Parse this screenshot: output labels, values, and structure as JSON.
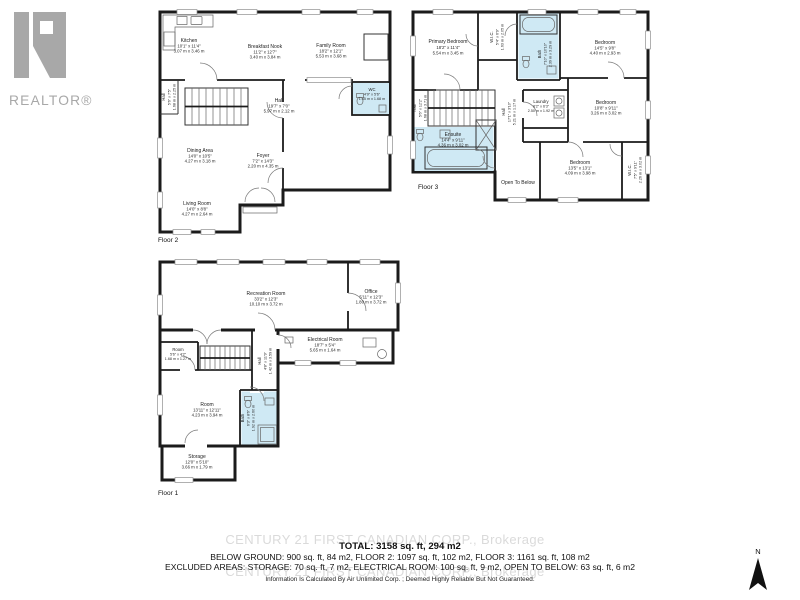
{
  "colors": {
    "wall": "#1b1b1b",
    "bath_fill": "#cfe9f4",
    "watermark": "#c5c5c5",
    "logo_gray": "#a8a8a8",
    "text": "#1c1c1c"
  },
  "logo": {
    "brand": "REALTOR®"
  },
  "compass": {
    "label": "N"
  },
  "watermark": {
    "text": "CENTURY 21 FIRST CANADIAN CORP., Brokerage"
  },
  "summary": {
    "total": "TOTAL: 3158 sq. ft, 294 m2",
    "line2": "BELOW GROUND: 900 sq. ft, 84 m2, FLOOR 2: 1097 sq. ft, 102 m2, FLOOR 3: 1161 sq. ft, 108 m2",
    "line3": "EXCLUDED AREAS: STORAGE: 70 sq. ft, 7 m2, ELECTRICAL ROOM: 100 sq. ft, 9 m2, OPEN TO BELOW: 63 sq. ft, 6 m2",
    "disclaimer": "Information Is Calculated By Air Unlimited Corp. ; Deemed Highly Reliable But Not Guaranteed."
  },
  "floor2": {
    "label": "Floor 2",
    "rooms": {
      "kitchen": {
        "name": "Kitchen",
        "imperial": "10'1\" x 11'4\"",
        "metric": "3.07 m x 3.46 m"
      },
      "breakfast_nook": {
        "name": "Breakfast Nook",
        "imperial": "11'2\" x 12'7\"",
        "metric": "3.40 m x 3.84 m"
      },
      "family_room": {
        "name": "Family Room",
        "imperial": "18'2\" x 12'1\"",
        "metric": "5.53 m x 3.68 m"
      },
      "hall_side": {
        "name": "Hall",
        "imperial": "5'6\" x 7'5\"",
        "metric": "1.68 m x 2.25 m"
      },
      "hall": {
        "name": "Hall",
        "imperial": "19'7\" x 7'0\"",
        "metric": "5.97 m x 2.12 m"
      },
      "wc": {
        "name": "WC",
        "imperial": "4'9\" x 5'6\"",
        "metric": "1.45 m x 1.68 m"
      },
      "dining_area": {
        "name": "Dining Area",
        "imperial": "14'0\" x 10'5\"",
        "metric": "4.27 m x 3.18 m"
      },
      "foyer": {
        "name": "Foyer",
        "imperial": "7'2\" x 14'3\"",
        "metric": "2.20 m x 4.35 m"
      },
      "living_room": {
        "name": "Living Room",
        "imperial": "14'0\" x 8'8\"",
        "metric": "4.27 m x 2.64 m"
      }
    }
  },
  "floor3": {
    "label": "Floor 3",
    "rooms": {
      "primary_bedroom": {
        "name": "Primary Bedroom",
        "imperial": "18'2\" x 11'4\"",
        "metric": "5.54 m x 3.45 m"
      },
      "wic_top": {
        "name": "W.I.C.",
        "imperial": "5'4\" x 6'9\"",
        "metric": "1.63 m x 2.05 m"
      },
      "bath": {
        "name": "Bath",
        "imperial": "7'10\" x 10'10\"",
        "metric": "2.39 m x 3.29 m"
      },
      "bedroom_ne": {
        "name": "Bedroom",
        "imperial": "14'5\" x 9'8\"",
        "metric": "4.40 m x 2.93 m"
      },
      "hall_stairs": {
        "name": "Hall",
        "imperial": "5'6\" x 12'2\"",
        "metric": "1.68 m x 3.71 m"
      },
      "hall_center": {
        "name": "Hall",
        "imperial": "17'1\" x 3'10\"",
        "metric": "5.21 m x 1.17 m"
      },
      "laundry": {
        "name": "Laundry",
        "imperial": "8'2\" x 6'3\"",
        "metric": "2.50 m x 1.92 m"
      },
      "bedroom_e": {
        "name": "Bedroom",
        "imperial": "10'8\" x 9'11\"",
        "metric": "3.26 m x 3.02 m"
      },
      "ensuite": {
        "name": "Ensuite",
        "imperial": "14'4\" x 9'11\"",
        "metric": "4.36 m x 3.02 m"
      },
      "open_to_below": {
        "name": "Open To Below"
      },
      "bedroom_s": {
        "name": "Bedroom",
        "imperial": "13'5\" x 13'1\"",
        "metric": "4.09 m x 3.98 m"
      },
      "wic_se": {
        "name": "W.I.C.",
        "imperial": "7'5\" x 9'11\"",
        "metric": "2.26 m x 3.02 m"
      }
    }
  },
  "floor1": {
    "label": "Floor 1",
    "rooms": {
      "recreation_room": {
        "name": "Recreation Room",
        "imperial": "33'2\" x 12'3\"",
        "metric": "10.10 m x 3.72 m"
      },
      "office": {
        "name": "Office",
        "imperial": "5'11\" x 12'3\"",
        "metric": "1.80 m x 3.72 m"
      },
      "electrical_room": {
        "name": "Electrical Room",
        "imperial": "18'7\" x 5'4\"",
        "metric": "5.65 m x 1.64 m"
      },
      "room_small": {
        "name": "Room",
        "imperial": "5'6\" x 4'2\"",
        "metric": "1.68 m x 1.27 m"
      },
      "hall": {
        "name": "Hall",
        "imperial": "4'8\" x 11'9\"",
        "metric": "1.42 m x 3.59 m"
      },
      "room_large": {
        "name": "Room",
        "imperial": "13'11\" x 12'11\"",
        "metric": "4.23 m x 3.94 m"
      },
      "bath": {
        "name": "Bath",
        "imperial": "6'3\" x 8'6\"",
        "metric": "1.92 m x 2.60 m"
      },
      "storage": {
        "name": "Storage",
        "imperial": "12'0\" x 5'10\"",
        "metric": "3.66 m x 1.79 m"
      }
    }
  }
}
